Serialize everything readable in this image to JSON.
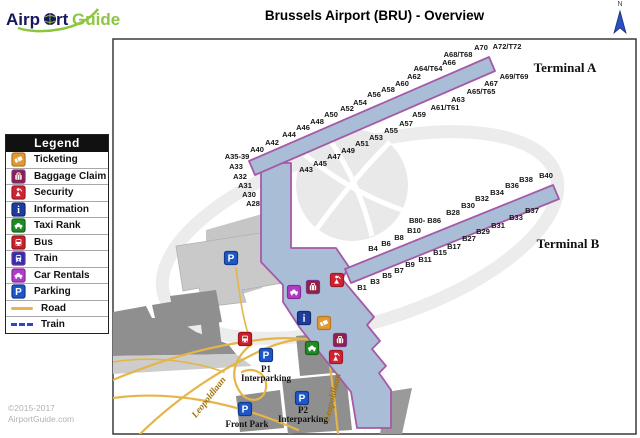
{
  "header": {
    "logo_part1": "Airp",
    "logo_part2": "rt",
    "logo_part3": "Guide",
    "title": "Brussels Airport (BRU) - Overview",
    "north_label": "N"
  },
  "footer": {
    "copyright_line1": "©2015-2017",
    "copyright_line2": "AirportGuide.com"
  },
  "legend": {
    "title": "Legend",
    "items": [
      {
        "icon": "ticketing",
        "label": "Ticketing"
      },
      {
        "icon": "baggage",
        "label": "Baggage Claim"
      },
      {
        "icon": "security",
        "label": "Security"
      },
      {
        "icon": "info",
        "label": "Information"
      },
      {
        "icon": "taxi",
        "label": "Taxi Rank"
      },
      {
        "icon": "bus",
        "label": "Bus"
      },
      {
        "icon": "train",
        "label": "Train"
      },
      {
        "icon": "car_rentals",
        "label": "Car Rentals"
      },
      {
        "icon": "parking",
        "label": "Parking"
      },
      {
        "swatch": "road",
        "label": "Road"
      },
      {
        "swatch": "rail",
        "label": "Train"
      }
    ]
  },
  "map": {
    "labels": {
      "terminal_a": "Terminal A",
      "terminal_b": "Terminal B",
      "p1": "P1",
      "p2": "P2",
      "interparking": "Interparking",
      "front_park": "Front Park",
      "road_name": "Leopoldlaan"
    },
    "terminal_a_gates": [
      {
        "t": "A40",
        "x": 257,
        "y": 152
      },
      {
        "t": "A42",
        "x": 272,
        "y": 145
      },
      {
        "t": "A44",
        "x": 289,
        "y": 137
      },
      {
        "t": "A46",
        "x": 303,
        "y": 130
      },
      {
        "t": "A48",
        "x": 317,
        "y": 124
      },
      {
        "t": "A50",
        "x": 331,
        "y": 117
      },
      {
        "t": "A52",
        "x": 347,
        "y": 111
      },
      {
        "t": "A54",
        "x": 360,
        "y": 105
      },
      {
        "t": "A56",
        "x": 374,
        "y": 97
      },
      {
        "t": "A58",
        "x": 388,
        "y": 92
      },
      {
        "t": "A60",
        "x": 402,
        "y": 86
      },
      {
        "t": "A62",
        "x": 414,
        "y": 79
      },
      {
        "t": "A64/T64",
        "x": 428,
        "y": 71
      },
      {
        "t": "A66",
        "x": 449,
        "y": 65
      },
      {
        "t": "A68/T68",
        "x": 458,
        "y": 57
      },
      {
        "t": "A70",
        "x": 481,
        "y": 50
      },
      {
        "t": "A72/T72",
        "x": 507,
        "y": 49
      },
      {
        "t": "A35-39",
        "x": 237,
        "y": 159
      },
      {
        "t": "A33",
        "x": 236,
        "y": 169
      },
      {
        "t": "A32",
        "x": 240,
        "y": 179
      },
      {
        "t": "A31",
        "x": 245,
        "y": 188
      },
      {
        "t": "A30",
        "x": 249,
        "y": 197
      },
      {
        "t": "A28",
        "x": 253,
        "y": 206
      },
      {
        "t": "A43",
        "x": 306,
        "y": 172
      },
      {
        "t": "A45",
        "x": 320,
        "y": 166
      },
      {
        "t": "A47",
        "x": 334,
        "y": 159
      },
      {
        "t": "A49",
        "x": 348,
        "y": 153
      },
      {
        "t": "A51",
        "x": 362,
        "y": 146
      },
      {
        "t": "A53",
        "x": 376,
        "y": 140
      },
      {
        "t": "A55",
        "x": 391,
        "y": 133
      },
      {
        "t": "A57",
        "x": 406,
        "y": 126
      },
      {
        "t": "A59",
        "x": 419,
        "y": 117
      },
      {
        "t": "A61/T61",
        "x": 445,
        "y": 110
      },
      {
        "t": "A63",
        "x": 458,
        "y": 102
      },
      {
        "t": "A65/T65",
        "x": 481,
        "y": 94
      },
      {
        "t": "A67",
        "x": 491,
        "y": 86
      },
      {
        "t": "A69/T69",
        "x": 514,
        "y": 79
      }
    ],
    "terminal_b_gates": [
      {
        "t": "B4",
        "x": 373,
        "y": 251
      },
      {
        "t": "B6",
        "x": 386,
        "y": 246
      },
      {
        "t": "B8",
        "x": 399,
        "y": 240
      },
      {
        "t": "B10",
        "x": 414,
        "y": 233
      },
      {
        "t": "B80- B86",
        "x": 425,
        "y": 223
      },
      {
        "t": "B28",
        "x": 453,
        "y": 215
      },
      {
        "t": "B30",
        "x": 468,
        "y": 208
      },
      {
        "t": "B32",
        "x": 482,
        "y": 201
      },
      {
        "t": "B34",
        "x": 497,
        "y": 195
      },
      {
        "t": "B36",
        "x": 512,
        "y": 188
      },
      {
        "t": "B38",
        "x": 526,
        "y": 182
      },
      {
        "t": "B40",
        "x": 546,
        "y": 178
      },
      {
        "t": "B1",
        "x": 362,
        "y": 290
      },
      {
        "t": "B3",
        "x": 375,
        "y": 284
      },
      {
        "t": "B5",
        "x": 387,
        "y": 278
      },
      {
        "t": "B7",
        "x": 399,
        "y": 273
      },
      {
        "t": "B9",
        "x": 410,
        "y": 267
      },
      {
        "t": "B11",
        "x": 425,
        "y": 262
      },
      {
        "t": "B15",
        "x": 440,
        "y": 255
      },
      {
        "t": "B17",
        "x": 454,
        "y": 249
      },
      {
        "t": "B27",
        "x": 469,
        "y": 241
      },
      {
        "t": "B29",
        "x": 483,
        "y": 234
      },
      {
        "t": "B31",
        "x": 498,
        "y": 228
      },
      {
        "t": "B33",
        "x": 516,
        "y": 220
      },
      {
        "t": "B37",
        "x": 532,
        "y": 213
      }
    ],
    "icons": [
      {
        "type": "parking",
        "x": 231,
        "y": 258
      },
      {
        "type": "car_rentals",
        "x": 294,
        "y": 292
      },
      {
        "type": "baggage",
        "x": 313,
        "y": 287
      },
      {
        "type": "security",
        "x": 337,
        "y": 280
      },
      {
        "type": "info",
        "x": 304,
        "y": 318
      },
      {
        "type": "ticketing",
        "x": 324,
        "y": 323
      },
      {
        "type": "baggage",
        "x": 340,
        "y": 340
      },
      {
        "type": "taxi",
        "x": 312,
        "y": 348
      },
      {
        "type": "security",
        "x": 336,
        "y": 357
      },
      {
        "type": "bus",
        "x": 245,
        "y": 339
      },
      {
        "type": "parking",
        "x": 266,
        "y": 355
      },
      {
        "type": "parking",
        "x": 245,
        "y": 409
      },
      {
        "type": "parking",
        "x": 302,
        "y": 398
      }
    ],
    "colors": {
      "terminal_fill": "#a9bdd6",
      "terminal_stroke": "#a55aa8",
      "road": "#e6b54a",
      "building_dark": "#8f8f8f",
      "building_light": "#c9c9c9",
      "watermark": "#ececec",
      "rail": "#2b46c8",
      "map_border": "#3a3a3a",
      "north_arrow": "#2a4fc0",
      "logo_navy": "#17175e",
      "logo_green": "#8cc63e"
    },
    "icon_colors": {
      "ticketing": {
        "fill": "#e09a35",
        "border": "#b5771f"
      },
      "baggage": {
        "fill": "#8e2240",
        "border": "#7b2e8e"
      },
      "security": {
        "fill": "#cf2233",
        "border": "#a31825"
      },
      "info": {
        "fill": "#1e3c9b",
        "border": "#142a70"
      },
      "taxi": {
        "fill": "#1f8b24",
        "border": "#14641a"
      },
      "bus": {
        "fill": "#c9202a",
        "border": "#991420"
      },
      "train": {
        "fill": "#2f2fb4",
        "border": "#7b2e8e"
      },
      "car_rentals": {
        "fill": "#b13cc4",
        "border": "#8a26a0"
      },
      "parking": {
        "fill": "#1d58c8",
        "border": "#12398c"
      }
    }
  }
}
